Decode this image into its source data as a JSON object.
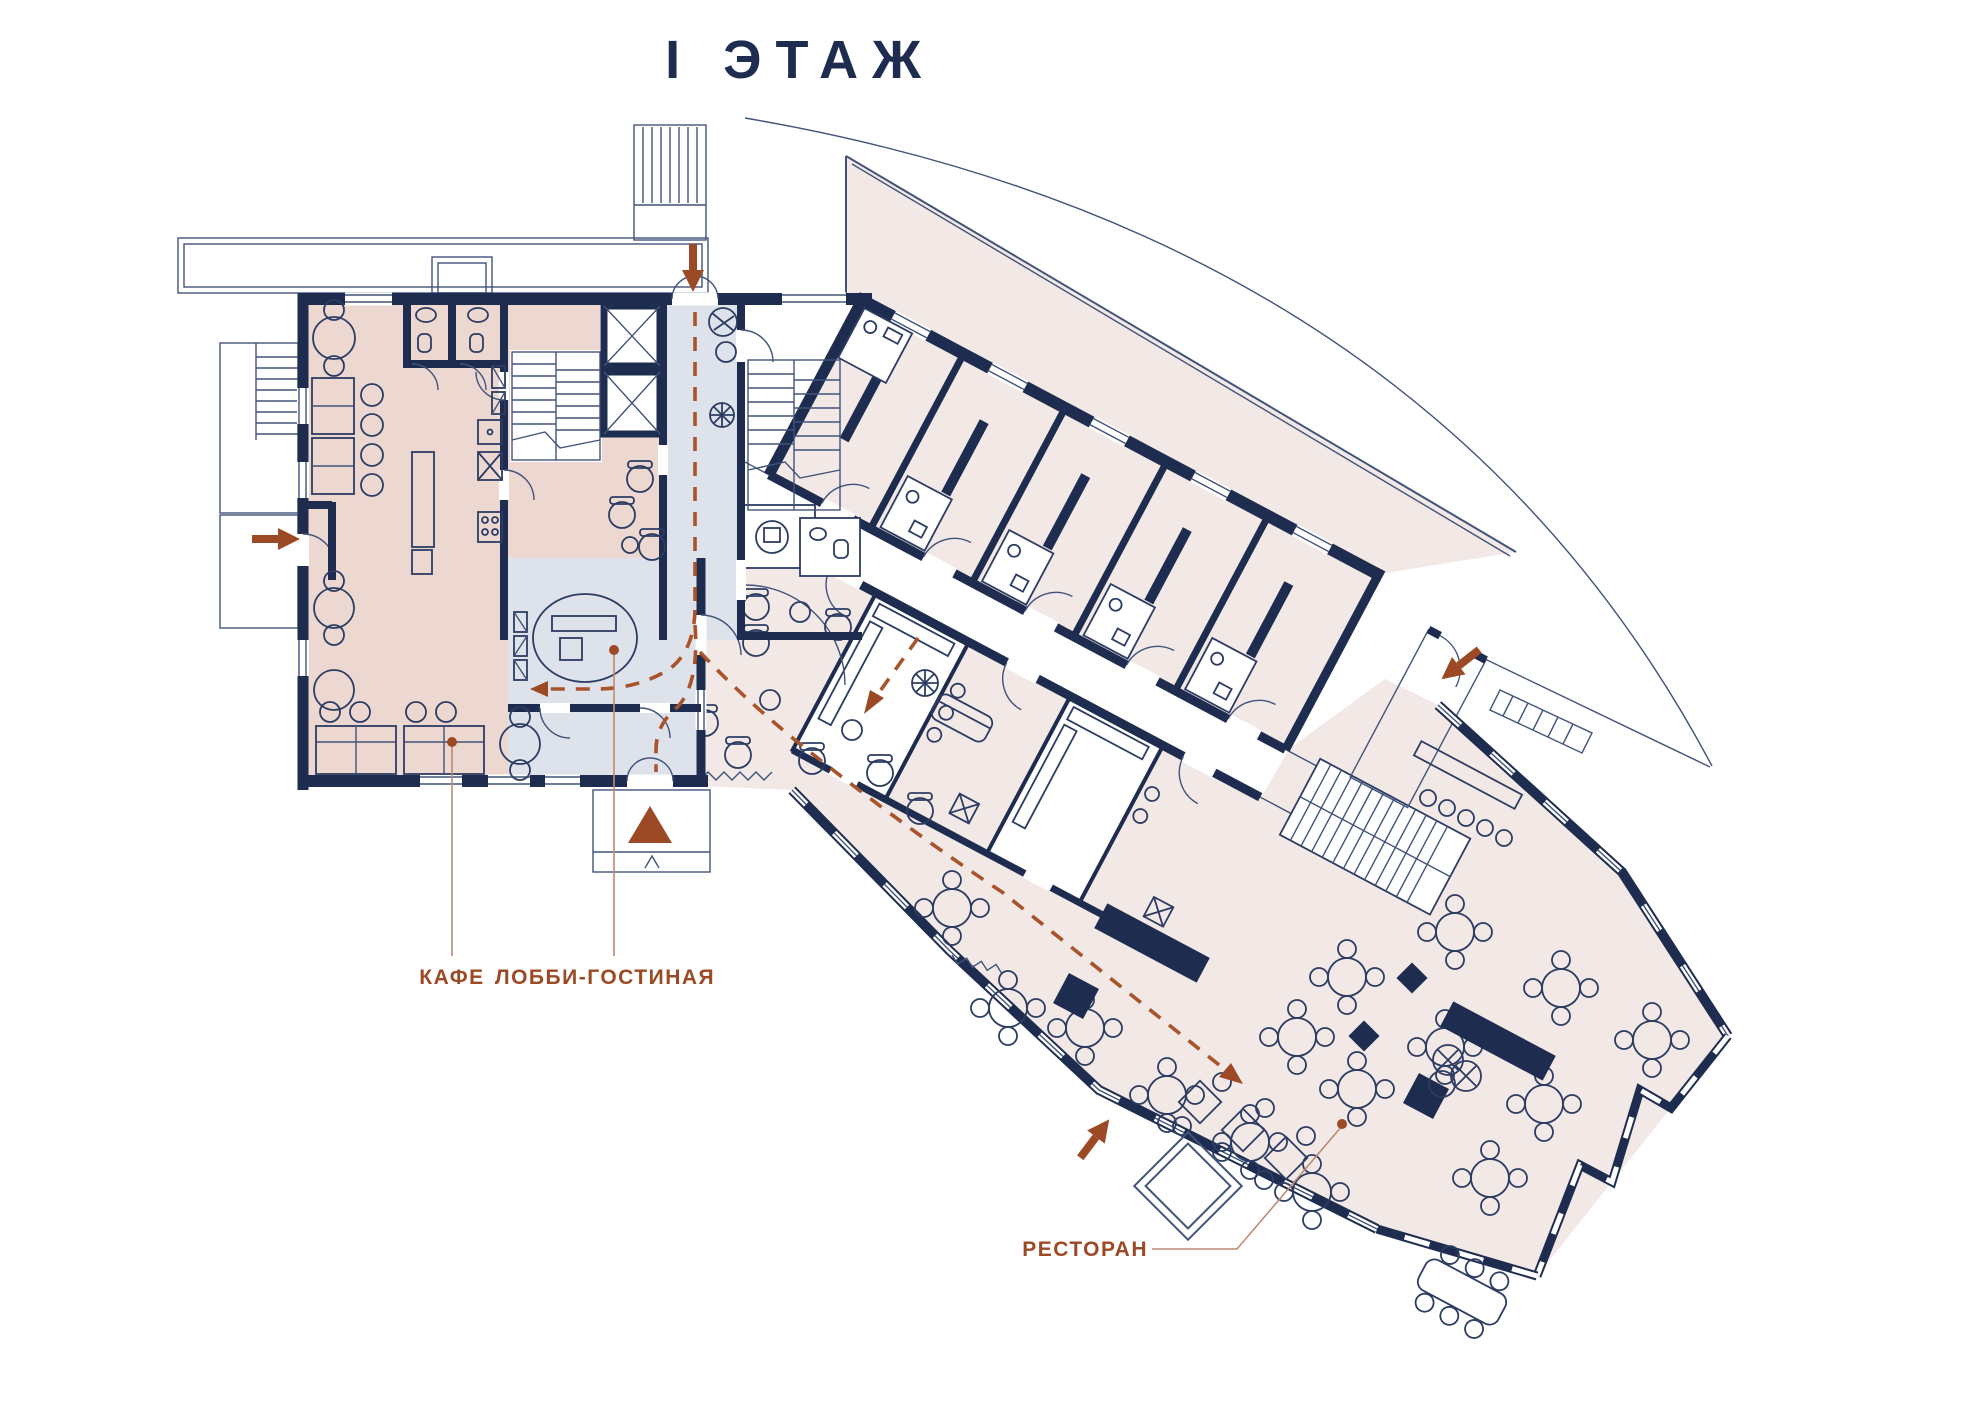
{
  "title": "I ЭТАЖ",
  "room_labels": {
    "cafe": "КАФЕ",
    "lobby": "ЛОББИ-ГОСТИНАЯ",
    "restaurant": "РЕСТОРАН"
  },
  "colors": {
    "wall_navy": "#1e2c50",
    "thin_line": "#41537a",
    "cafe_fill": "#ecd8d1",
    "rooms_fill": "#f2e8e5",
    "lobby_fill": "#dee2ea",
    "accent_terracotta": "#9c4a26",
    "leader_line": "#c08a72",
    "dashed_path": "#a9532a"
  },
  "icons": {
    "entrance_arrows": [
      "entrance-arrow-left",
      "entrance-arrow-top",
      "entrance-arrow-right",
      "entrance-arrow-restaurant"
    ],
    "main_entrance_marker": "main-entrance-triangle",
    "circulation_path": "dashed-route"
  }
}
